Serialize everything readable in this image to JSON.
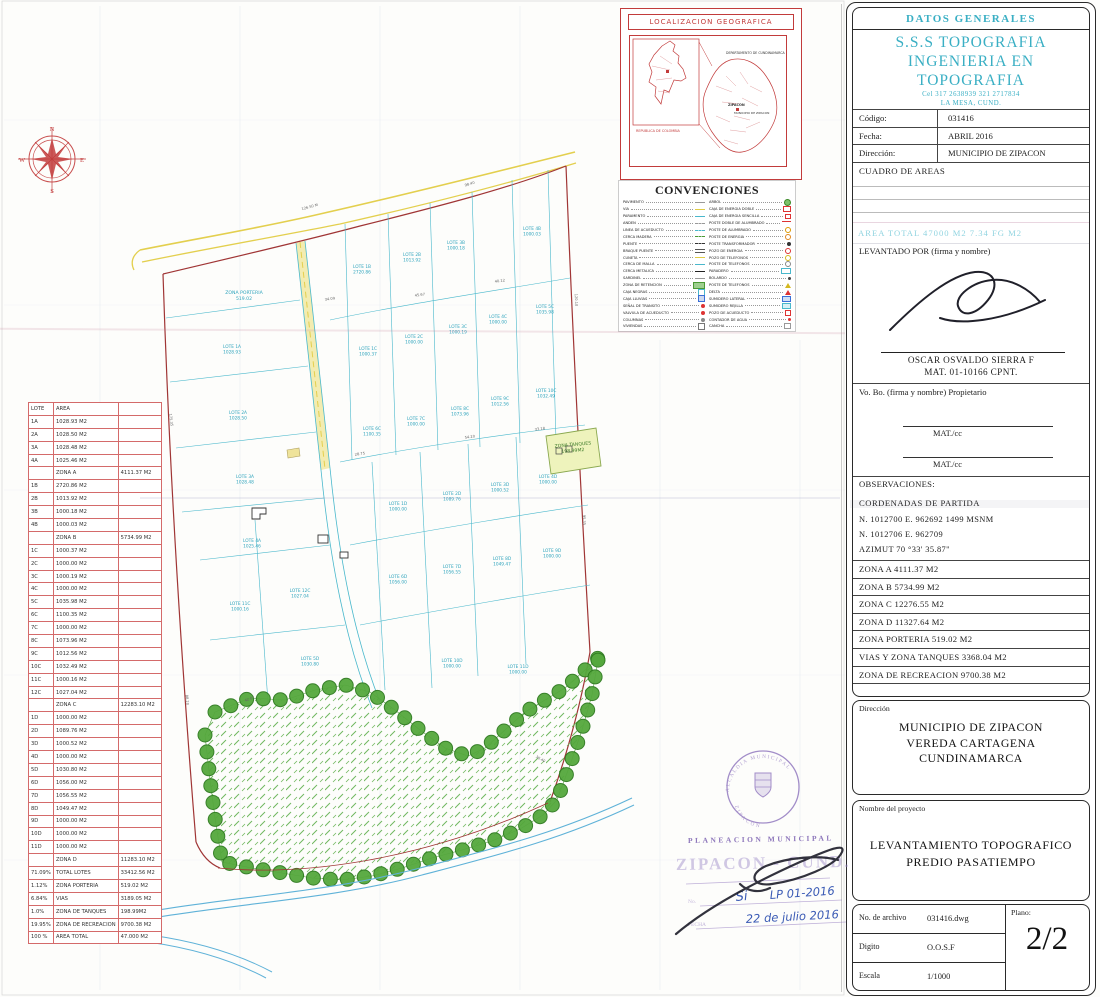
{
  "title_block": {
    "header": "DATOS GENERALES",
    "company": {
      "line1": "S.S.S TOPOGRAFIA",
      "line2": "INGENIERIA EN TOPOGRAFIA",
      "phone": "Cel 317 2638939  321 2717834",
      "city": "LA MESA, CUND."
    },
    "fields": [
      {
        "label": "Código:",
        "value": "031416"
      },
      {
        "label": "Fecha:",
        "value": "ABRIL 2016"
      },
      {
        "label": "Dirección:",
        "value": "MUNICIPIO DE ZIPACON"
      }
    ],
    "cuadro_de_areas_label": "CUADRO DE AREAS",
    "area_total_row": "AREA  TOTAL        47000  M2        7.34  FG  M2",
    "levantado_por_label": "LEVANTADO POR (firma y nombre)",
    "surveyor_name": "OSCAR OSVALDO SIERRA F",
    "surveyor_mat": "MAT.  01-10166 CPNT.",
    "vobo_label": "Vo. Bo. (firma y nombre) Propietario",
    "mat_cc_1": "MAT./cc",
    "mat_cc_2": "MAT./cc",
    "observaciones_label": "OBSERVACIONES:",
    "coordenadas_title": "CORDENADAS DE PARTIDA",
    "coord_line1": "N.   1012700   E.   962692     1499  MSNM",
    "coord_line2": "N.   1012706   E.   962709",
    "azimut": "AZIMUT   70 °33' 35.87\"",
    "zonas": [
      "ZONA A   4111.37 M2",
      "ZONA B   5734.99 M2",
      "ZONA C   12276.55 M2",
      "ZONA D   11327.64 M2",
      "ZONA PORTERIA   519.02 M2",
      "VIAS  Y ZONA TANQUES 3368.04 M2",
      "ZONA DE RECREACION   9700.38 M2"
    ],
    "direccion_box": {
      "label": "Dirección",
      "lines": [
        "MUNICIPIO DE ZIPACON",
        "VEREDA CARTAGENA",
        "CUNDINAMARCA"
      ]
    },
    "proyecto_box": {
      "label": "Nombre del proyecto",
      "lines": [
        "LEVANTAMIENTO TOPOGRAFICO",
        "PREDIO PASATIEMPO"
      ]
    },
    "archivo_box": {
      "rows": [
        {
          "label": "No. de archivo",
          "value": "031416.dwg"
        },
        {
          "label": "Digito",
          "value": "O.O.S.F"
        },
        {
          "label": "Escala",
          "value": "1/1000"
        }
      ],
      "plano_label": "Plano:",
      "plano_value": "2/2"
    }
  },
  "lot_table": {
    "headers": [
      "LOTE",
      "AREA",
      ""
    ],
    "rows": [
      [
        "1A",
        "1028.93 M2",
        ""
      ],
      [
        "2A",
        "1028.50 M2",
        ""
      ],
      [
        "3A",
        "1028.48 M2",
        ""
      ],
      [
        "4A",
        "1025.46 M2",
        ""
      ],
      [
        "",
        "ZONA A",
        "4111.37 M2"
      ],
      [
        "1B",
        "2720.86 M2",
        ""
      ],
      [
        "2B",
        "1013.92 M2",
        ""
      ],
      [
        "3B",
        "1000.18 M2",
        ""
      ],
      [
        "4B",
        "1000.03 M2",
        ""
      ],
      [
        "",
        "ZONA B",
        "5734.99 M2"
      ],
      [
        "1C",
        "1000.37 M2",
        ""
      ],
      [
        "2C",
        "1000.00 M2",
        ""
      ],
      [
        "3C",
        "1000.19 M2",
        ""
      ],
      [
        "4C",
        "1000.00 M2",
        ""
      ],
      [
        "5C",
        "1035.98 M2",
        ""
      ],
      [
        "6C",
        "1100.35 M2",
        ""
      ],
      [
        "7C",
        "1000.00 M2",
        ""
      ],
      [
        "8C",
        "1073.96 M2",
        ""
      ],
      [
        "9C",
        "1012.56 M2",
        ""
      ],
      [
        "10C",
        "1032.49 M2",
        ""
      ],
      [
        "11C",
        "1000.16 M2",
        ""
      ],
      [
        "12C",
        "1027.04 M2",
        ""
      ],
      [
        "",
        "ZONA C",
        "12283.10 M2"
      ],
      [
        "1D",
        "1000.00 M2",
        ""
      ],
      [
        "2D",
        "1089.76 M2",
        ""
      ],
      [
        "3D",
        "1000.52 M2",
        ""
      ],
      [
        "4D",
        "1000.00 M2",
        ""
      ],
      [
        "5D",
        "1030.80 M2",
        ""
      ],
      [
        "6D",
        "1056.00 M2",
        ""
      ],
      [
        "7D",
        "1056.55 M2",
        ""
      ],
      [
        "8D",
        "1049.47 M2",
        ""
      ],
      [
        "9D",
        "1000.00 M2",
        ""
      ],
      [
        "10D",
        "1000.00 M2",
        ""
      ],
      [
        "11D",
        "1000.00 M2",
        ""
      ],
      [
        "",
        "ZONA D",
        "11283.10 M2"
      ],
      [
        "71.09%",
        "TOTAL LOTES",
        "33412.56 M2"
      ],
      [
        "1.12%",
        "ZONA PORTERIA",
        "519.02 M2"
      ],
      [
        "6.84%",
        "VIAS",
        "3189.05 M2"
      ],
      [
        "1.0%",
        "ZONA DE TANQUES",
        "198.99M2"
      ],
      [
        "19.95%",
        "ZONA DE RECREACION",
        "9700.38 M2"
      ],
      [
        "100 %",
        "AREA TOTAL",
        "47.000 M2"
      ]
    ]
  },
  "localizacion": {
    "title": "LOCALIZACION  GEOGRAFICA",
    "country_label": "REPUBLICA DE COLOMBIA",
    "dept_label": "DEPARTAMENTO DE CUNDINAMARCA",
    "town_label": "ZIPACON",
    "municipio_label": "MUNICIPIO DE ZIPACON"
  },
  "convenciones": {
    "title": "CONVENCIONES",
    "left": [
      {
        "label": "PAVIMENTO",
        "glyph": "line-gray"
      },
      {
        "label": "VIA",
        "glyph": "line-yellow"
      },
      {
        "label": "PARAMENTO",
        "glyph": "line-cyan"
      },
      {
        "label": "ANDEN",
        "glyph": "line-gray-dash"
      },
      {
        "label": "LINEA DE ACUEDUCTO",
        "glyph": "line-cyan-dash"
      },
      {
        "label": "CERCA MADERA",
        "glyph": "line-green-dash"
      },
      {
        "label": "PUENTE",
        "glyph": "line-dark-dash"
      },
      {
        "label": "BRAQUE PUENTE",
        "glyph": "line-double"
      },
      {
        "label": "CUNETA",
        "glyph": "line-yellow2"
      },
      {
        "label": "CERCA DE MALLA",
        "glyph": "line-cyan2"
      },
      {
        "label": "CERCA METALICA",
        "glyph": "line-dark"
      },
      {
        "label": "SARDINEL",
        "glyph": "line-gray2"
      },
      {
        "label": "ZONA DE RETENCION",
        "glyph": "swatch-green"
      },
      {
        "label": "CAJA NEGRAS",
        "glyph": "box-cyan"
      },
      {
        "label": "CAJA LLUVIAS",
        "glyph": "box-blue"
      },
      {
        "label": "SEÑAL DE TRANSITO",
        "glyph": "dot-red"
      },
      {
        "label": "VALVULA DE ACUEDUCTO",
        "glyph": "dot-red2"
      },
      {
        "label": "COLUMNAS",
        "glyph": "dot-gray"
      },
      {
        "label": "VIVIENDAS",
        "glyph": "box-gray"
      }
    ],
    "right": [
      {
        "label": "ARBOL",
        "glyph": "tree-green"
      },
      {
        "label": "CAJA DE ENERGIA DOBLE",
        "glyph": "sq-red"
      },
      {
        "label": "CAJA DE ENERGIA SENCILLA",
        "glyph": "sq-red-small"
      },
      {
        "label": "POSTE DOBLE DE ALUMBRADO",
        "glyph": "poste-doble"
      },
      {
        "label": "POSTE DE ALUMBRADO",
        "glyph": "poste"
      },
      {
        "label": "POSTE DE ENERGIA",
        "glyph": "circ-orange"
      },
      {
        "label": "POSTE TRANSFORMADOR",
        "glyph": "circ-dark"
      },
      {
        "label": "POZO DE ENERGIA",
        "glyph": "circ-red"
      },
      {
        "label": "POZO DE TELEFONOS",
        "glyph": "circ-yellow"
      },
      {
        "label": "POSTE DE TELEFONOS",
        "glyph": "circ-outline"
      },
      {
        "label": "PARADERO",
        "glyph": "rect-cyan"
      },
      {
        "label": "BOLARDO",
        "glyph": "dot-dark"
      },
      {
        "label": "POSTE DE TELEFONOS",
        "glyph": "tri-yellow"
      },
      {
        "label": "DELTA",
        "glyph": "tri-red"
      },
      {
        "label": "SUMIDERO LATERAL",
        "glyph": "rect-blue"
      },
      {
        "label": "SUMIDERO REJILLA",
        "glyph": "rect-cyan2"
      },
      {
        "label": "POZO DE ACUEDUCTO",
        "glyph": "p-red"
      },
      {
        "label": "CONTADOR DE AGUA",
        "glyph": "dot-red3"
      },
      {
        "label": "CANCHA",
        "glyph": "c-gray"
      }
    ]
  },
  "map": {
    "compass": [
      "N",
      "E",
      "S",
      "W"
    ],
    "zona_tanques": {
      "l1": "ZONA TANQUES",
      "l2": "198.99M2"
    },
    "zona_porteria": {
      "l1": "ZONA PORTERIA",
      "l2": "519.02"
    },
    "lot_labels": [
      {
        "x": 232,
        "y": 348,
        "l1": "LOTE 1A",
        "l2": "1028.93"
      },
      {
        "x": 238,
        "y": 414,
        "l1": "LOTE 2A",
        "l2": "1028.50"
      },
      {
        "x": 245,
        "y": 478,
        "l1": "LOTE 3A",
        "l2": "1028.48"
      },
      {
        "x": 252,
        "y": 542,
        "l1": "LOTE 4A",
        "l2": "1025.46"
      },
      {
        "x": 362,
        "y": 268,
        "l1": "LOTE 1B",
        "l2": "2720.86"
      },
      {
        "x": 412,
        "y": 256,
        "l1": "LOTE 2B",
        "l2": "1013.92"
      },
      {
        "x": 456,
        "y": 244,
        "l1": "LOTE 3B",
        "l2": "1000.18"
      },
      {
        "x": 532,
        "y": 230,
        "l1": "LOTE 4B",
        "l2": "1000.03"
      },
      {
        "x": 368,
        "y": 350,
        "l1": "LOTE 1C",
        "l2": "1000.37"
      },
      {
        "x": 414,
        "y": 338,
        "l1": "LOTE 2C",
        "l2": "1000.00"
      },
      {
        "x": 458,
        "y": 328,
        "l1": "LOTE 3C",
        "l2": "1000.19"
      },
      {
        "x": 498,
        "y": 318,
        "l1": "LOTE 4C",
        "l2": "1000.00"
      },
      {
        "x": 545,
        "y": 308,
        "l1": "LOTE 5C",
        "l2": "1035.98"
      },
      {
        "x": 372,
        "y": 430,
        "l1": "LOTE 6C",
        "l2": "1100.35"
      },
      {
        "x": 416,
        "y": 420,
        "l1": "LOTE 7C",
        "l2": "1000.00"
      },
      {
        "x": 460,
        "y": 410,
        "l1": "LOTE 8C",
        "l2": "1073.96"
      },
      {
        "x": 500,
        "y": 400,
        "l1": "LOTE 9C",
        "l2": "1012.56"
      },
      {
        "x": 546,
        "y": 392,
        "l1": "LOTE 10C",
        "l2": "1032.49"
      },
      {
        "x": 240,
        "y": 605,
        "l1": "LOTE 11C",
        "l2": "1000.16"
      },
      {
        "x": 300,
        "y": 592,
        "l1": "LOTE 12C",
        "l2": "1027.04"
      },
      {
        "x": 398,
        "y": 505,
        "l1": "LOTE 1D",
        "l2": "1000.00"
      },
      {
        "x": 452,
        "y": 495,
        "l1": "LOTE 2D",
        "l2": "1089.76"
      },
      {
        "x": 500,
        "y": 486,
        "l1": "LOTE 3D",
        "l2": "1000.52"
      },
      {
        "x": 548,
        "y": 478,
        "l1": "LOTE 4D",
        "l2": "1000.00"
      },
      {
        "x": 310,
        "y": 660,
        "l1": "LOTE 5D",
        "l2": "1030.80"
      },
      {
        "x": 398,
        "y": 578,
        "l1": "LOTE 6D",
        "l2": "1056.00"
      },
      {
        "x": 452,
        "y": 568,
        "l1": "LOTE 7D",
        "l2": "1056.55"
      },
      {
        "x": 502,
        "y": 560,
        "l1": "LOTE 8D",
        "l2": "1049.47"
      },
      {
        "x": 552,
        "y": 552,
        "l1": "LOTE 9D",
        "l2": "1000.00"
      },
      {
        "x": 452,
        "y": 662,
        "l1": "LOTE 10D",
        "l2": "1000.00"
      },
      {
        "x": 518,
        "y": 668,
        "l1": "LOTE 11D",
        "l2": "1000.00"
      }
    ],
    "dims": [
      {
        "x": 310,
        "y": 208,
        "r": -15,
        "t": "126.50 M"
      },
      {
        "x": 470,
        "y": 185,
        "r": -17,
        "t": "98.40"
      },
      {
        "x": 575,
        "y": 300,
        "r": 88,
        "t": "120.10"
      },
      {
        "x": 583,
        "y": 520,
        "r": 88,
        "t": "95.35"
      },
      {
        "x": 170,
        "y": 420,
        "r": 83,
        "t": "175.35"
      },
      {
        "x": 186,
        "y": 700,
        "r": 84,
        "t": "88.20"
      },
      {
        "x": 330,
        "y": 300,
        "r": -8,
        "t": "34.09"
      },
      {
        "x": 420,
        "y": 296,
        "r": -8,
        "t": "45.67"
      },
      {
        "x": 500,
        "y": 282,
        "r": -8,
        "t": "40.12"
      },
      {
        "x": 360,
        "y": 455,
        "r": -8,
        "t": "28.75"
      },
      {
        "x": 470,
        "y": 438,
        "r": -8,
        "t": "54.20"
      },
      {
        "x": 540,
        "y": 430,
        "r": -8,
        "t": "33.18"
      },
      {
        "x": 250,
        "y": 700,
        "r": -20,
        "t": "42.87"
      },
      {
        "x": 540,
        "y": 760,
        "r": 30,
        "t": "36.40"
      }
    ]
  },
  "stamps": {
    "seal_top": "ALCALDIA MUNICIPAL",
    "seal_bottom": "ZIPACON",
    "planeacion": "PLANEACION MUNICIPAL",
    "zipacon": "ZIPACON - CUND.",
    "field_no": "No.",
    "field_fecha": "FECHA",
    "hand_si": "Si",
    "hand_lp": "LP 01-2016",
    "hand_fecha": "22 de julio 2016"
  }
}
